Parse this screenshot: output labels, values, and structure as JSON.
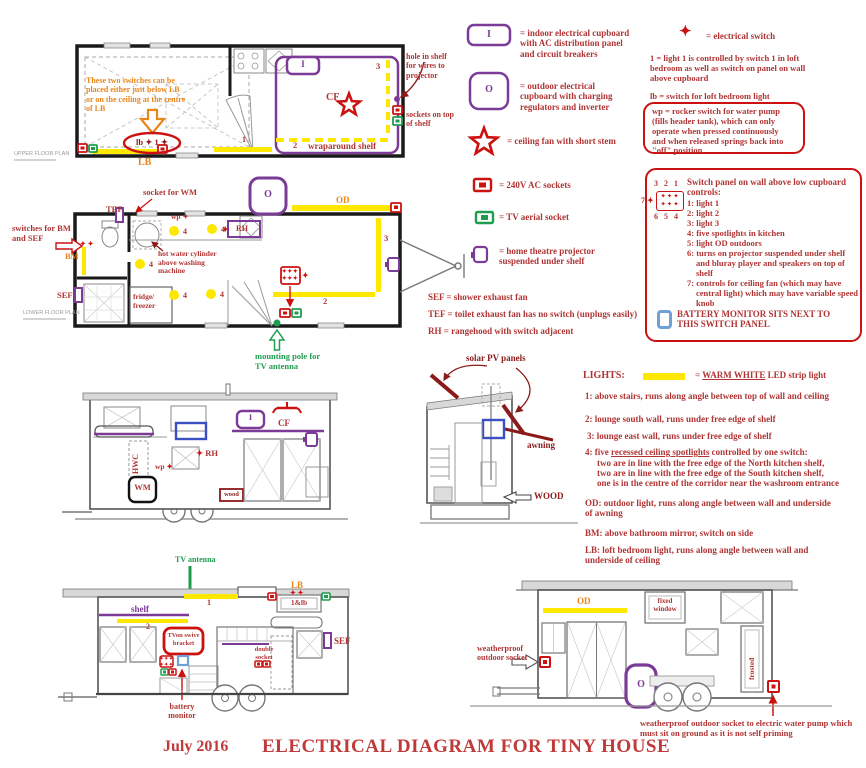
{
  "title": {
    "date": "July 2016",
    "main": "ELECTRICAL DIAGRAM FOR TINY HOUSE"
  },
  "icons": {
    "diamond": "✦",
    "diamond_row": "✦✦✦",
    "diamond_pair": "✦ ✦"
  },
  "plans": {
    "upper_label": "UPPER FLOOR PLAN",
    "lower_label": "LOWER FLOOR PLAN"
  },
  "upper": {
    "note": "These two switches can be placed either just below LB or on the ceiling at the centre of LB",
    "oval": "lb ✦ 1 ✦",
    "lb": "LB",
    "n1": "1",
    "n2": "2",
    "n3": "3",
    "i": "I",
    "cf": "CF",
    "wraparound": "wraparound shelf",
    "hole": "hole in shelf for wires to projector",
    "sockets": "sockets on top of shelf"
  },
  "lower": {
    "tef": "TEF",
    "socket_wm": "socket for WM",
    "switches": "switches for BM and SEF",
    "bm": "BM",
    "sef": "SEF",
    "wp": "wp",
    "rh": "RH",
    "o": "O",
    "od": "OD",
    "hwc": "hot water cylinder above washing machine",
    "fridge": "fridge/ freezer",
    "n2": "2",
    "n3": "3",
    "n4": "4",
    "mount": "mounting pole for TV antenna"
  },
  "legend": {
    "i_sym": "I",
    "i_text": "= indoor electrical cupboard with AC distribution panel and circuit breakers",
    "o_sym": "O",
    "o_text": "= outdoor electrical cupboard with charging regulators and inverter",
    "fan": "= ceiling fan with short stem",
    "socket": "= 240V AC sockets",
    "tv": "= TV aerial socket",
    "projector": "= home theatre projector suspended under shelf",
    "sef": "SEF = shower exhaust fan",
    "tef": "TEF = toilet exhaust fan has no switch (unplugs easily)",
    "rh": "RH = rangehood with switch adjacent"
  },
  "right": {
    "switch": "= electrical switch",
    "light1": "1 = light 1 is controlled by switch 1 in loft bedroom as well as switch on panel on wall above cupboard",
    "lb": "lb = switch for loft bedroom light",
    "wp": "wp = rocker switch for water pump (fills header tank), which can only operate when pressed continuously and when released springs back into \"off\" position",
    "panel_top": "3  2  1",
    "panel_bottom": "6  5  4",
    "panel_seven": "7",
    "heading": "Switch panel on wall above low cupboard controls:",
    "item1": "1: light 1",
    "item2": "2: light 2",
    "item3": "3: light 3",
    "item4": "4: five spotlights in kitchen",
    "item5": "5: light OD outdoors",
    "item6": "6: turns on projector suspended under shelf and bluray player and speakers on top of shelf",
    "item7": "7:  controls for ceiling fan (which may have central light) which may have variable speed knob",
    "battery": "BATTERY MONITOR SITS NEXT TO THIS SWITCH PANEL"
  },
  "midleft": {
    "i": "I",
    "cf": "CF",
    "hwc": "HWC",
    "rh": "RH",
    "wp": "wp",
    "wm": "WM",
    "wood": "wood"
  },
  "midright": {
    "solar": "solar PV panels",
    "awning": "awning",
    "wood": "WOOD"
  },
  "lights": {
    "heading": "LIGHTS:",
    "eq": "=",
    "warm": "WARM WHITE",
    "suffix": " LED strip light",
    "i1": "1: above stairs, runs along angle between top of wall and ceiling",
    "i2": "2: lounge south wall, runs under free edge of shelf",
    "i3": "3: lounge east wall, runs under free edge of shelf",
    "i4pre": "4: five ",
    "i4u": "recessed ceiling spotlights",
    "i4post": " controlled by one switch:",
    "i4a": "two are in line with the free edge of the North kitchen shelf,",
    "i4b": "two are in line with the free edge of the South kitchen shelf,",
    "i4c": "one is in the centre of the corridor near the washroom entrance",
    "od": "OD: outdoor light, runs along angle between wall and underside of awning",
    "bm": "BM: above bathroom mirror, switch on side",
    "lb": "LB: loft bedroom light, runs along angle between wall and underside of ceiling"
  },
  "botleft": {
    "antenna": "TV antenna",
    "lb": "LB",
    "n1": "1",
    "shelf": "shelf",
    "n2": "2",
    "lblb": "1&lb",
    "bracket": "TVon swive bracket",
    "double": "double socket",
    "battery": "battery monitor",
    "sef": "SEF"
  },
  "botright": {
    "od": "OD",
    "fixed": "fixed window",
    "frosted": "frosted",
    "wpsock": "weatherproof outdoor socket",
    "o": "O",
    "caption": "weatherproof outdoor socket to electric water pump which must sit on ground as it is not self priming"
  }
}
